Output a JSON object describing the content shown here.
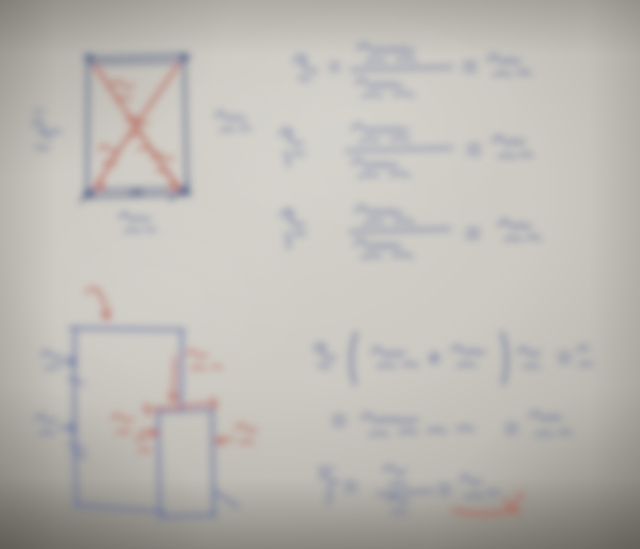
{
  "photo": {
    "kind": "blurred handwritten notes photo",
    "palette": {
      "paper": "#ccc9c2",
      "paper_light": "#d3d1ca",
      "paper_mid": "#b9b6af",
      "paper_dark": "#9a978f",
      "blue": "#5c6b9d",
      "navy": "#47557f",
      "red": "#b4564a"
    },
    "ink_opacity": 0.88,
    "blur_px": 4,
    "figures": [
      {
        "name": "braced-section-diagram",
        "strokes": [
          {
            "n": "frame-outline",
            "c": "navy",
            "w": 2.6,
            "d": "M88,58 L184,55 L187,194 L87,197 Z"
          },
          {
            "n": "frame-top-inner-edge",
            "c": "navy",
            "w": 2.2,
            "d": "M89,64 L184,62"
          },
          {
            "n": "frame-bottom-inner-edge",
            "c": "navy",
            "w": 2.0,
            "d": "M89,190 L185,188"
          },
          {
            "n": "joint-top-left",
            "c": "navy",
            "w": 6,
            "d": "M87,57 l5,1"
          },
          {
            "n": "joint-top-right",
            "c": "navy",
            "w": 6,
            "d": "M182,56 l5,1"
          },
          {
            "n": "joint-bottom-left",
            "c": "navy",
            "w": 6,
            "d": "M86,194 l5,0"
          },
          {
            "n": "joint-bottom-right",
            "c": "navy",
            "w": 6,
            "d": "M183,192 l5,1"
          },
          {
            "n": "support-hatch-left",
            "c": "navy",
            "w": 2.4,
            "d": "M80,202 l19,-17"
          },
          {
            "n": "support-hatch-right",
            "c": "navy",
            "w": 2.4,
            "d": "M170,200 l19,-17"
          },
          {
            "n": "bottom-joint-mark",
            "c": "navy",
            "w": 2.4,
            "d": "M132,193 q4,-6 9,-1 q-3,6 -9,1"
          },
          {
            "n": "brace-diagonal-main",
            "c": "red",
            "w": 2.8,
            "d": "M95,66 C114,92 148,146 178,189"
          },
          {
            "n": "brace-diagonal-cross",
            "c": "red",
            "w": 2.8,
            "d": "M178,65 C157,96 116,150 96,189"
          },
          {
            "n": "brace-arrowhead-left",
            "c": "red",
            "w": 2.6,
            "d": "M96,189 l3,-9 M96,189 l9,-2"
          },
          {
            "n": "brace-arrowhead-right",
            "c": "red",
            "w": 2.6,
            "d": "M178,189 l-3,-9 M178,189 l-9,-2"
          },
          {
            "n": "brace-label-upper",
            "c": "red",
            "w": 2.2,
            "d": "M112,86 q5,-9 10,-2 q4,7 11,1 M117,100 q7,-5 14,-1"
          },
          {
            "n": "brace-label-center",
            "c": "red",
            "w": 2.2,
            "d": "M127,122 q5,-9 11,-1 q4,6 10,1 M131,137 q7,-6 13,-1 M138,150 q6,-5 12,0"
          },
          {
            "n": "brace-label-lower-left",
            "c": "red",
            "w": 2.2,
            "d": "M99,150 q5,-8 10,-1 q4,6 10,0 M103,164 q7,-5 13,0"
          },
          {
            "n": "brace-label-lower-right",
            "c": "red",
            "w": 2.2,
            "d": "M152,158 q5,-8 11,-1 q4,6 10,0 M157,172 q7,-5 13,1"
          },
          {
            "n": "left-force-label",
            "c": "blue",
            "w": 2.2,
            "d": "M33,126 q4,-10 9,-2 q3,6 -2,9 q7,-1 9,6 M50,134 q5,-7 10,-1 M36,146 q7,4 13,2"
          },
          {
            "n": "left-force-tick",
            "c": "blue",
            "w": 1.8,
            "d": "M35,113 q4,-5 8,-1"
          },
          {
            "n": "right-force-label",
            "c": "blue",
            "w": 2.2,
            "d": "M216,117 q4,-9 9,-1 q4,6 10,0 q4,5 10,2 M221,131 q7,-5 13,0 M240,129 q5,-3 10,0"
          },
          {
            "n": "bottom-force-label",
            "c": "blue",
            "w": 2.2,
            "d": "M120,218 q4,-9 9,-1 q4,6 10,0 q5,5 11,1 M125,232 q8,-5 15,0 M145,230 q5,-2 10,1"
          }
        ]
      },
      {
        "name": "reaction-equations",
        "strokes": [
          {
            "n": "eq1-symbol",
            "c": "blue",
            "w": 2.3,
            "d": "M294,62 q6,-11 12,-2 q-8,3 -1,8 q6,4 12,2 M299,77 q6,4 11,1"
          },
          {
            "n": "eq1-equals-left",
            "c": "blue",
            "w": 2.0,
            "d": "M330,64 h9 M330,70 h9"
          },
          {
            "n": "eq1-numerator",
            "c": "blue",
            "w": 2.3,
            "d": "M358,50 q5,-10 11,-2 q5,7 11,0 q6,7 12,0 q5,6 11,0 q5,5 11,2 M366,62 q10,-5 19,-1 M397,60 q10,-4 18,1"
          },
          {
            "n": "eq1-fraction-bar",
            "c": "blue",
            "w": 2.2,
            "d": "M351,70 L452,67"
          },
          {
            "n": "eq1-denominator",
            "c": "blue",
            "w": 2.3,
            "d": "M356,84 q5,-9 11,-1 q5,7 11,0 q6,6 12,0 q5,6 11,1 M363,97 q10,-5 19,-1 M394,95 q10,-4 19,1"
          },
          {
            "n": "eq1-equals-right",
            "c": "blue",
            "w": 2.2,
            "d": "M464,63 h12 M464,70 h12"
          },
          {
            "n": "eq1-result",
            "c": "blue",
            "w": 2.3,
            "d": "M488,61 q5,-10 10,-2 q5,7 11,0 q5,6 11,1 M494,75 q8,-4 16,0 M517,73 q7,-3 13,1"
          },
          {
            "n": "eq2-symbol",
            "c": "blue",
            "w": 2.3,
            "d": "M280,135 q6,-11 12,-2 q-8,3 -1,8 q6,4 12,2 M285,152 q5,6 3,14 M293,152 q6,4 11,1"
          },
          {
            "n": "eq2-numerator",
            "c": "blue",
            "w": 2.3,
            "d": "M352,130 q5,-10 11,-2 q5,7 11,0 q6,7 12,0 q5,6 11,0 q5,5 11,2 M360,142 q10,-5 19,-1 M391,140 q10,-4 18,1"
          },
          {
            "n": "eq2-fraction-bar",
            "c": "blue",
            "w": 2.2,
            "d": "M346,151 L452,148"
          },
          {
            "n": "eq2-denominator",
            "c": "blue",
            "w": 2.3,
            "d": "M352,164 q5,-9 11,-1 q5,7 11,0 q6,6 12,0 q5,6 11,1 M359,177 q10,-5 19,-1 M390,175 q10,-4 19,1"
          },
          {
            "n": "eq2-equals",
            "c": "blue",
            "w": 2.2,
            "d": "M468,146 h12 M468,153 h12"
          },
          {
            "n": "eq2-result",
            "c": "blue",
            "w": 2.3,
            "d": "M493,142 q5,-10 10,-2 q5,7 11,0 q5,6 10,1 M499,157 q8,-4 16,0 M520,155 q6,-3 12,1"
          },
          {
            "n": "eq3-symbol",
            "c": "blue",
            "w": 2.3,
            "d": "M281,216 q6,-11 12,-2 q-8,3 -1,8 q6,4 12,2 M286,233 q5,7 2,15 M294,232 q6,4 11,1"
          },
          {
            "n": "eq3-numerator",
            "c": "blue",
            "w": 2.3,
            "d": "M356,212 q5,-10 11,-2 q5,7 11,0 q6,7 12,0 q5,6 11,2 M364,224 q10,-5 19,-1 M395,222 q10,-4 18,1"
          },
          {
            "n": "eq3-fraction-bar",
            "c": "blue",
            "w": 2.2,
            "d": "M350,232 L450,229"
          },
          {
            "n": "eq3-denominator",
            "c": "blue",
            "w": 2.3,
            "d": "M355,245 q5,-9 11,-1 q5,7 11,0 q6,6 12,0 q5,6 11,1 M362,258 q10,-5 19,-1 M393,256 q10,-4 19,1"
          },
          {
            "n": "eq3-equals",
            "c": "blue",
            "w": 2.2,
            "d": "M467,230 h12 M467,237 h12"
          },
          {
            "n": "eq3-result",
            "c": "blue",
            "w": 2.3,
            "d": "M499,226 q5,-10 10,-2 q5,7 11,0 q5,6 11,1 M505,240 q8,-4 16,0 M527,238 q7,-3 13,1"
          }
        ]
      },
      {
        "name": "composite-shape-diagram",
        "strokes": [
          {
            "n": "shape-top-edge",
            "c": "blue",
            "w": 2.8,
            "d": "M70,328 L184,330"
          },
          {
            "n": "shape-left-edge",
            "c": "blue",
            "w": 2.8,
            "d": "M75,328 Q73,420 77,507"
          },
          {
            "n": "shape-bottom-edge",
            "c": "blue",
            "w": 2.8,
            "d": "M76,505 L164,512"
          },
          {
            "n": "shape-right-upper-edge",
            "c": "blue",
            "w": 2.8,
            "d": "M182,330 L181,409"
          },
          {
            "n": "notch-left-edge",
            "c": "blue",
            "w": 2.8,
            "d": "M158,411 L160,518"
          },
          {
            "n": "notch-right-edge",
            "c": "blue",
            "w": 2.8,
            "d": "M212,409 L214,516"
          },
          {
            "n": "notch-bottom-edge",
            "c": "blue",
            "w": 2.8,
            "d": "M160,517 L216,515"
          },
          {
            "n": "notch-top-edge",
            "c": "blue",
            "w": 2.2,
            "d": "M159,412 L211,410"
          },
          {
            "n": "shape-corner-diagonal",
            "c": "blue",
            "w": 2.4,
            "d": "M214,491 L238,507"
          },
          {
            "n": "height-label-upper",
            "c": "blue",
            "w": 2.2,
            "d": "M42,356 q4,-9 9,-1 q4,7 10,0 M46,369 q7,-4 14,-1"
          },
          {
            "n": "height-arrow-upper",
            "c": "blue",
            "w": 2.2,
            "d": "M60,362 L76,361 M76,361 l-7,-4 M76,361 l-7,5"
          },
          {
            "n": "edge-tick-upper",
            "c": "blue",
            "w": 2.2,
            "d": "M68,378 l16,6"
          },
          {
            "n": "height-label-lower",
            "c": "blue",
            "w": 2.2,
            "d": "M36,420 q4,-9 9,-1 q4,7 10,0 M40,434 q7,-4 14,0"
          },
          {
            "n": "height-arrow-lower",
            "c": "blue",
            "w": 2.2,
            "d": "M58,427 L76,428 M76,428 l-7,-4 M76,428 l-7,5"
          },
          {
            "n": "edge-tick-lower",
            "c": "blue",
            "w": 2.2,
            "d": "M68,443 l17,7 M72,452 l14,6"
          },
          {
            "n": "top-red-arrow",
            "c": "red",
            "w": 2.5,
            "d": "M97,289 q3,4 6,11 q3,8 5,19 M108,319 l-7,-5 M108,319 l1,-8"
          },
          {
            "n": "top-red-tick",
            "c": "red",
            "w": 2.2,
            "d": "M86,293 q5,-8 11,-2"
          },
          {
            "n": "notch-height-arrow",
            "c": "red",
            "w": 2.3,
            "d": "M175,357 L173,401 M173,401 l-4,-7 M173,401 l5,-6"
          },
          {
            "n": "notch-height-label",
            "c": "red",
            "w": 2.2,
            "d": "M186,355 q5,-8 10,-1 q5,6 11,0 M191,369 q7,-4 14,0 M212,367 q5,-2 9,1"
          },
          {
            "n": "notch-width-dim",
            "c": "red",
            "w": 2.3,
            "d": "M145,410 L217,403 M148,415 l-3,-11 M215,409 l-2,-11"
          },
          {
            "n": "notch-corner-tick",
            "c": "red",
            "w": 2.2,
            "d": "M136,441 q5,-7 10,-1 M139,451 q6,-3 11,0"
          },
          {
            "n": "notch-left-label",
            "c": "red",
            "w": 2.2,
            "d": "M112,419 q5,-8 10,-1 q5,6 11,0 M117,433 q7,-4 13,0"
          },
          {
            "n": "notch-left-arrow",
            "c": "red",
            "w": 2.2,
            "d": "M140,431 L157,433 M157,433 l-6,-4 M157,433 l-6,4"
          },
          {
            "n": "notch-right-label",
            "c": "red",
            "w": 2.2,
            "d": "M236,429 q5,-8 10,-1 q4,6 10,1 M240,443 q7,-4 13,0"
          },
          {
            "n": "notch-right-arrow",
            "c": "red",
            "w": 2.2,
            "d": "M233,439 L216,441 M216,441 l6,-4 M216,441 l6,4"
          }
        ]
      },
      {
        "name": "centroid-equations",
        "strokes": [
          {
            "n": "sum-symbol",
            "c": "blue",
            "w": 2.3,
            "d": "M314,350 q6,-10 11,-2 q-7,3 -1,8 q6,3 11,1 M318,365 q7,3 12,0"
          },
          {
            "n": "sum-bracket-open",
            "c": "blue",
            "w": 2.8,
            "d": "M356,333 q-9,26 -1,51"
          },
          {
            "n": "sum-term-1",
            "c": "blue",
            "w": 2.3,
            "d": "M372,353 q5,-9 10,-1 q5,7 11,0 q5,6 11,0 M378,367 q9,-4 17,0 M403,365 q8,-3 14,1"
          },
          {
            "n": "sum-plus",
            "c": "blue",
            "w": 2.3,
            "d": "M429,358 h11 M434,352 v12"
          },
          {
            "n": "sum-term-2",
            "c": "blue",
            "w": 2.3,
            "d": "M452,351 q5,-9 10,-1 q5,7 11,0 q5,6 11,1 M458,366 q9,-4 17,0"
          },
          {
            "n": "sum-bracket-close",
            "c": "blue",
            "w": 2.8,
            "d": "M502,333 q9,26 1,51"
          },
          {
            "n": "sum-factor",
            "c": "blue",
            "w": 2.3,
            "d": "M518,353 q5,-9 10,-1 q5,6 11,0 M524,367 q8,-3 15,0"
          },
          {
            "n": "sum-equals",
            "c": "blue",
            "w": 2.2,
            "d": "M559,354 h11 M559,361 h11"
          },
          {
            "n": "sum-rhs",
            "c": "blue",
            "w": 2.3,
            "d": "M578,351 q5,-8 10,-1 M580,365 q6,-3 12,0"
          },
          {
            "n": "calc-equals",
            "c": "blue",
            "w": 2.2,
            "d": "M333,417 h12 M333,424 h12"
          },
          {
            "n": "calc-terms",
            "c": "blue",
            "w": 2.3,
            "d": "M362,419 q5,-9 10,-1 q5,7 11,0 q5,6 11,0 q5,6 11,1 q6,5 12,0 M370,435 q9,-4 18,0 M399,433 q9,-4 18,0 M428,431 q9,-3 17,1 M457,429 q8,-3 16,1"
          },
          {
            "n": "calc-equals-2",
            "c": "blue",
            "w": 2.2,
            "d": "M506,425 h11 M506,432 h11"
          },
          {
            "n": "calc-result",
            "c": "blue",
            "w": 2.3,
            "d": "M530,417 q5,-9 10,-1 q5,7 11,0 q5,5 10,1 M536,435 q8,-4 16,0 M559,433 q7,-3 12,1"
          },
          {
            "n": "xbar-symbol",
            "c": "blue",
            "w": 2.3,
            "d": "M319,469 h14 M320,479 q5,-9 9,0 q4,7 9,1 M329,486 q3,10 -2,18"
          },
          {
            "n": "xbar-equals",
            "c": "blue",
            "w": 2.2,
            "d": "M345,483 h11 M345,490 h11"
          },
          {
            "n": "xbar-numerator",
            "c": "blue",
            "w": 2.3,
            "d": "M384,471 q5,-9 10,-1 q5,7 11,0 M390,485 q8,-4 16,0"
          },
          {
            "n": "xbar-fraction-bar",
            "c": "blue",
            "w": 2.2,
            "d": "M377,494 L433,491"
          },
          {
            "n": "xbar-denominator",
            "c": "blue",
            "w": 2.3,
            "d": "M388,501 q5,-8 10,-1 q5,6 10,0 M392,513 q8,-3 15,0"
          },
          {
            "n": "xbar-equals-2",
            "c": "blue",
            "w": 2.2,
            "d": "M439,486 h11 M439,493 h11"
          },
          {
            "n": "xbar-result",
            "c": "blue",
            "w": 2.3,
            "d": "M460,481 q5,-9 10,-1 q5,7 11,0 M466,497 q8,-4 16,0 M487,493 q6,-2 11,1"
          },
          {
            "n": "result-underline",
            "c": "red",
            "w": 2.8,
            "d": "M454,510 q20,6 44,3 q13,-2 23,-2"
          },
          {
            "n": "result-checkmark",
            "c": "red",
            "w": 2.5,
            "d": "M505,499 q4,7 7,10 q5,-11 11,-16"
          }
        ]
      }
    ]
  }
}
